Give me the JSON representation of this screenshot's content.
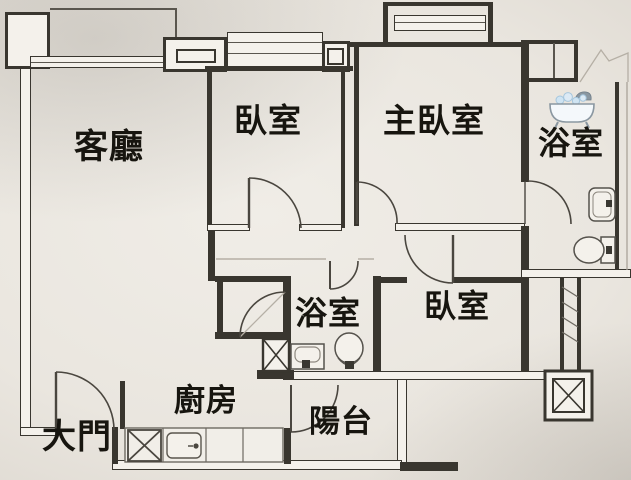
{
  "rooms": {
    "living_room": {
      "label": "客廳"
    },
    "bedroom_top": {
      "label": "臥室"
    },
    "master_bedroom": {
      "label": "主臥室"
    },
    "bathroom_top": {
      "label": "浴室"
    },
    "bathroom_middle": {
      "label": "浴室"
    },
    "bedroom_right": {
      "label": "臥室"
    },
    "kitchen": {
      "label": "廚房"
    },
    "balcony": {
      "label": "陽台"
    },
    "entrance": {
      "label": "大門"
    }
  },
  "icons": {
    "bathtub": "bathtub-with-bubbles",
    "toilets": 2,
    "washbasins": 2,
    "kitchen_sink": 1,
    "elevator_shaft": 1
  },
  "colors": {
    "paper": "#f0ede7",
    "paper_edge": "#cdc7be",
    "line": "#39362f",
    "line_soft": "#5a564e",
    "faint": "#aaa399",
    "ink": "#17150f",
    "tub_stroke": "#8a97a1",
    "tub_fill": "#f4f8fb",
    "water": "#cfe4f2"
  }
}
